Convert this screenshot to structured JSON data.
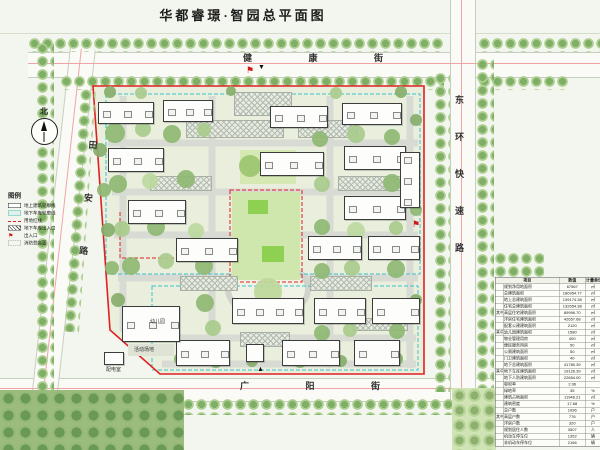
{
  "title": "华都睿璟·智园总平面图",
  "north_label": "北",
  "markers": {
    "flag": "⚑",
    "gate_down": "▼",
    "gate_up": "▲"
  },
  "streets": {
    "top": "健 康 街",
    "bottom": "广 阳 街",
    "left": "田安路",
    "right": "东环快速路"
  },
  "legend": {
    "title": "图例",
    "items": [
      {
        "label": "地上建筑轮廓线",
        "symbol": "sym-building"
      },
      {
        "label": "地下车库轮廓线",
        "symbol": "sym-garage"
      },
      {
        "label": "用地红线",
        "symbol": "sym-redline"
      },
      {
        "label": "地下车库出入口",
        "symbol": "sym-garage-ent"
      },
      {
        "label": "出入口",
        "symbol": "sym-flag"
      },
      {
        "label": "消防登高面",
        "symbol": "sym-fire"
      }
    ]
  },
  "site_labels": [
    {
      "text": "幼儿园",
      "x": 150,
      "y": 318
    },
    {
      "text": "活动场地",
      "x": 134,
      "y": 346
    },
    {
      "text": "配电室",
      "x": 106,
      "y": 366
    }
  ],
  "table": {
    "headers": [
      "项目",
      "数值",
      "计量单位"
    ],
    "rows": [
      {
        "group": "",
        "item": "规划净用地面积",
        "value": "67567",
        "unit": "㎡"
      },
      {
        "group": "",
        "item": "总建筑面积",
        "value": "180954.77",
        "unit": "㎡"
      },
      {
        "group": "",
        "item": "地上总建筑面积",
        "value": "139174.38",
        "unit": "㎡"
      },
      {
        "group": "",
        "item": "住宅总建筑面积",
        "value": "132654.38",
        "unit": "㎡"
      },
      {
        "group": "其中",
        "item": "高层住宅建筑面积",
        "value": "89996.70",
        "unit": "㎡"
      },
      {
        "group": "其中",
        "item": "洋房住宅建筑面积",
        "value": "42657.68",
        "unit": "㎡"
      },
      {
        "group": "",
        "item": "配套公建建筑面积",
        "value": "2120",
        "unit": "㎡"
      },
      {
        "group": "其中",
        "item": "幼儿园建筑面积",
        "value": "1580",
        "unit": "㎡"
      },
      {
        "group": "其中",
        "item": "物业管理用房",
        "value": "400",
        "unit": "㎡"
      },
      {
        "group": "其中",
        "item": "便民服务用房",
        "value": "50",
        "unit": "㎡"
      },
      {
        "group": "其中",
        "item": "公厕建筑面积",
        "value": "50",
        "unit": "㎡"
      },
      {
        "group": "其中",
        "item": "门卫建筑面积",
        "value": "40",
        "unit": "㎡"
      },
      {
        "group": "",
        "item": "地下总建筑面积",
        "value": "41780.39",
        "unit": "㎡"
      },
      {
        "group": "其中",
        "item": "地下车库建筑面积",
        "value": "19126.39",
        "unit": "㎡"
      },
      {
        "group": "其中",
        "item": "地下人防建筑面积",
        "value": "22654.00",
        "unit": "㎡"
      },
      {
        "group": "",
        "item": "容积率",
        "value": "2.06",
        "unit": ""
      },
      {
        "group": "",
        "item": "绿地率",
        "value": "35",
        "unit": "%"
      },
      {
        "group": "",
        "item": "建筑占地面积",
        "value": "11948.21",
        "unit": "㎡"
      },
      {
        "group": "",
        "item": "建筑密度",
        "value": "17.68",
        "unit": "%"
      },
      {
        "group": "",
        "item": "总户数",
        "value": "1096",
        "unit": "户"
      },
      {
        "group": "其中",
        "item": "高层户数",
        "value": "776",
        "unit": "户"
      },
      {
        "group": "其中",
        "item": "洋房户数",
        "value": "320",
        "unit": "户"
      },
      {
        "group": "",
        "item": "规划居住人数",
        "value": "3507",
        "unit": "人"
      },
      {
        "group": "",
        "item": "机动车停车位",
        "value": "1352",
        "unit": "辆"
      },
      {
        "group": "",
        "item": "非机动车停车位",
        "value": "2166",
        "unit": "辆"
      }
    ]
  },
  "plan": {
    "colors": {
      "boundary_red": "#e02020",
      "garage_cyan": "#3cc0cd",
      "road_gray": "#d8dbd4",
      "site_fill": "#e9efdc"
    },
    "buildings": [
      {
        "x": 98,
        "y": 102,
        "w": 56,
        "h": 22
      },
      {
        "x": 163,
        "y": 100,
        "w": 50,
        "h": 22
      },
      {
        "x": 270,
        "y": 106,
        "w": 58,
        "h": 22
      },
      {
        "x": 342,
        "y": 103,
        "w": 60,
        "h": 22
      },
      {
        "x": 108,
        "y": 148,
        "w": 56,
        "h": 24
      },
      {
        "x": 260,
        "y": 152,
        "w": 64,
        "h": 24
      },
      {
        "x": 344,
        "y": 146,
        "w": 62,
        "h": 24
      },
      {
        "x": 128,
        "y": 200,
        "w": 58,
        "h": 24
      },
      {
        "x": 344,
        "y": 196,
        "w": 62,
        "h": 24
      },
      {
        "x": 400,
        "y": 152,
        "w": 20,
        "h": 56
      },
      {
        "x": 176,
        "y": 238,
        "w": 62,
        "h": 24
      },
      {
        "x": 308,
        "y": 236,
        "w": 54,
        "h": 24
      },
      {
        "x": 368,
        "y": 236,
        "w": 52,
        "h": 24
      },
      {
        "x": 232,
        "y": 298,
        "w": 72,
        "h": 26
      },
      {
        "x": 314,
        "y": 298,
        "w": 52,
        "h": 26
      },
      {
        "x": 372,
        "y": 298,
        "w": 48,
        "h": 26
      },
      {
        "x": 176,
        "y": 340,
        "w": 54,
        "h": 26
      },
      {
        "x": 246,
        "y": 344,
        "w": 18,
        "h": 18
      },
      {
        "x": 282,
        "y": 340,
        "w": 58,
        "h": 26
      },
      {
        "x": 354,
        "y": 340,
        "w": 46,
        "h": 26
      },
      {
        "x": 122,
        "y": 306,
        "w": 58,
        "h": 36
      },
      {
        "x": 104,
        "y": 352,
        "w": 20,
        "h": 13
      }
    ],
    "lawns": [
      {
        "x": 232,
        "y": 192,
        "w": 68,
        "h": 88,
        "c": "#cfe6ad"
      },
      {
        "x": 240,
        "y": 150,
        "w": 56,
        "h": 34,
        "c": "#d6e9b4"
      },
      {
        "x": 248,
        "y": 200,
        "w": 20,
        "h": 14,
        "c": "#8ed152"
      },
      {
        "x": 262,
        "y": 246,
        "w": 22,
        "h": 16,
        "c": "#8ed152"
      },
      {
        "x": 128,
        "y": 344,
        "w": 46,
        "h": 12,
        "c": "#dfe3d6"
      }
    ],
    "greens": [
      [
        115,
        133,
        10,
        "#8fb873"
      ],
      [
        143,
        129,
        8,
        "#a9cb8c"
      ],
      [
        172,
        134,
        9,
        "#8fb873"
      ],
      [
        204,
        130,
        7,
        "#a9cb8c"
      ],
      [
        118,
        184,
        9,
        "#8fb873"
      ],
      [
        150,
        181,
        8,
        "#bcd99e"
      ],
      [
        186,
        179,
        9,
        "#8fb873"
      ],
      [
        122,
        229,
        8,
        "#a9cb8c"
      ],
      [
        156,
        227,
        9,
        "#8fb873"
      ],
      [
        196,
        231,
        8,
        "#bcd99e"
      ],
      [
        131,
        266,
        9,
        "#8fb873"
      ],
      [
        166,
        261,
        8,
        "#a9cb8c"
      ],
      [
        204,
        266,
        9,
        "#8fb873"
      ],
      [
        250,
        166,
        11,
        "#9cc46f"
      ],
      [
        285,
        164,
        9,
        "#bcd99e"
      ],
      [
        320,
        139,
        8,
        "#8fb873"
      ],
      [
        356,
        134,
        9,
        "#a9cb8c"
      ],
      [
        392,
        137,
        8,
        "#8fb873"
      ],
      [
        322,
        184,
        8,
        "#a9cb8c"
      ],
      [
        392,
        183,
        9,
        "#8fb873"
      ],
      [
        322,
        227,
        8,
        "#8fb873"
      ],
      [
        356,
        231,
        9,
        "#bcd99e"
      ],
      [
        396,
        228,
        7,
        "#a9cb8c"
      ],
      [
        322,
        271,
        8,
        "#8fb873"
      ],
      [
        352,
        268,
        8,
        "#a9cb8c"
      ],
      [
        396,
        269,
        9,
        "#8fb873"
      ],
      [
        205,
        303,
        9,
        "#8fb873"
      ],
      [
        213,
        328,
        8,
        "#a9cb8c"
      ],
      [
        322,
        333,
        8,
        "#8fb873"
      ],
      [
        350,
        330,
        7,
        "#a9cb8c"
      ],
      [
        397,
        331,
        8,
        "#8fb873"
      ],
      [
        181,
        359,
        7,
        "#87ae6b"
      ],
      [
        216,
        361,
        7,
        "#87ae6b"
      ],
      [
        252,
        361,
        6,
        "#87ae6b"
      ],
      [
        300,
        361,
        7,
        "#87ae6b"
      ],
      [
        341,
        361,
        6,
        "#87ae6b"
      ],
      [
        396,
        359,
        7,
        "#87ae6b"
      ],
      [
        110,
        92,
        6,
        "#87ae6b"
      ],
      [
        141,
        93,
        6,
        "#a9cb8c"
      ],
      [
        231,
        91,
        5,
        "#87ae6b"
      ],
      [
        336,
        93,
        6,
        "#a9cb8c"
      ],
      [
        401,
        92,
        6,
        "#87ae6b"
      ],
      [
        100,
        150,
        7,
        "#87ae6b"
      ],
      [
        104,
        190,
        7,
        "#8fb873"
      ],
      [
        108,
        230,
        7,
        "#87ae6b"
      ],
      [
        112,
        268,
        7,
        "#8fb873"
      ],
      [
        118,
        300,
        7,
        "#87ae6b"
      ],
      [
        416,
        120,
        6,
        "#87ae6b"
      ],
      [
        416,
        210,
        6,
        "#8fb873"
      ],
      [
        416,
        300,
        6,
        "#87ae6b"
      ],
      [
        268,
        292,
        14,
        "#bcd89a"
      ]
    ],
    "hatches": [
      [
        234,
        92,
        56,
        22
      ],
      [
        186,
        120,
        96,
        16
      ],
      [
        298,
        120,
        58,
        16
      ],
      [
        150,
        176,
        60,
        13
      ],
      [
        338,
        176,
        70,
        13
      ],
      [
        180,
        276,
        56,
        13
      ],
      [
        310,
        276,
        60,
        13
      ],
      [
        240,
        332,
        48,
        13
      ],
      [
        352,
        318,
        54,
        11
      ]
    ]
  }
}
